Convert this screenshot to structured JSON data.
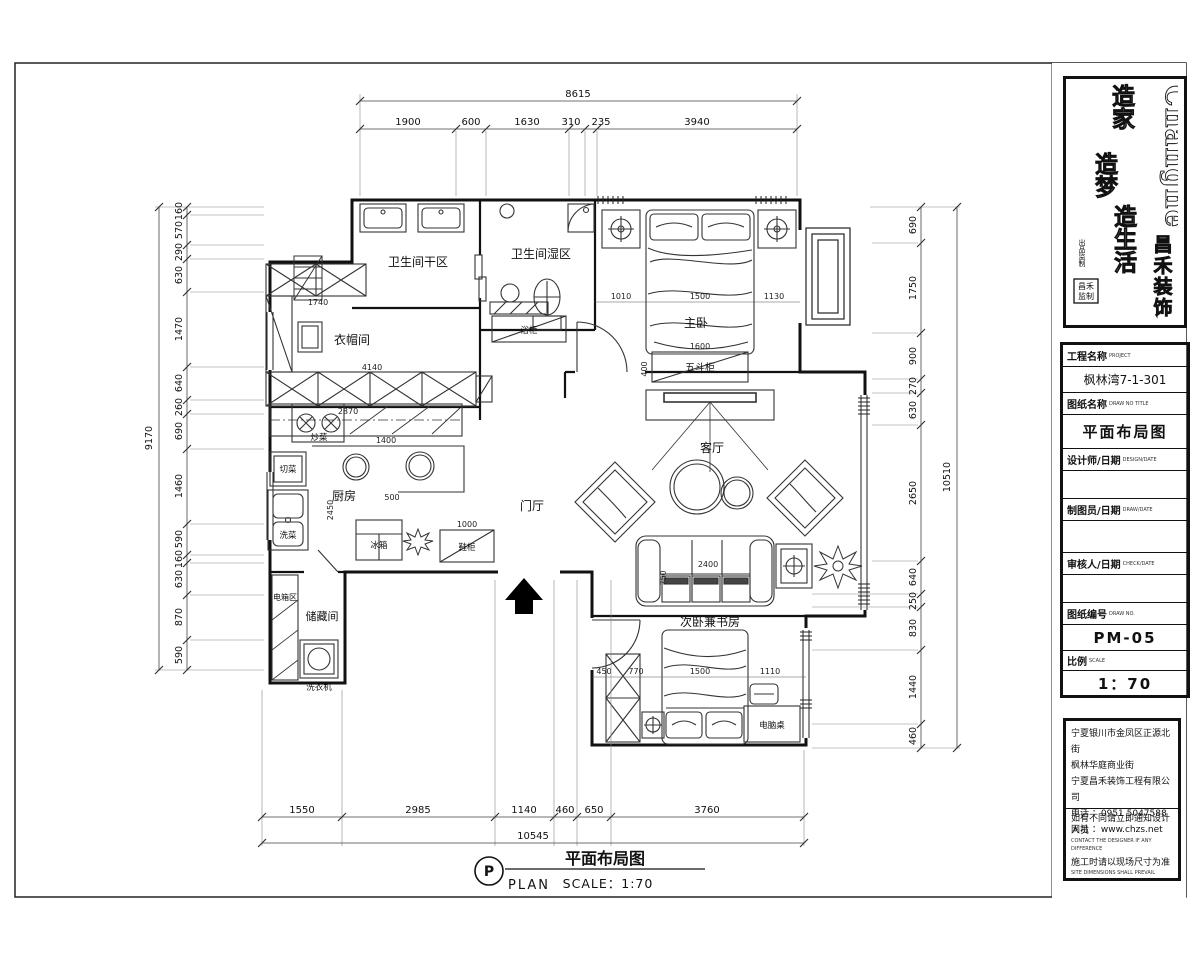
{
  "logo": {
    "brand_en": "Changhe",
    "brand_cn": [
      "昌",
      "禾",
      "装",
      "饰"
    ],
    "slogan1": "造家",
    "slogan2": "造梦",
    "slogan3": "造生活",
    "side_note": "出品监制",
    "seal_line1": "昌禾",
    "seal_line2": "监制"
  },
  "titleblock": {
    "project_label": "工程名称",
    "project_label_en": "PROJECT",
    "project_value": "枫林湾7-1-301",
    "drawing_label": "图纸名称",
    "drawing_label_en": "DRAW NO TITLE",
    "drawing_value": "平面布局图",
    "designer_label": "设计师/日期",
    "designer_label_en": "DESIGN/DATE",
    "drafter_label": "制图员/日期",
    "drafter_label_en": "DRAW/DATE",
    "checker_label": "审核人/日期",
    "checker_label_en": "CHECK/DATE",
    "number_label": "图纸编号",
    "number_label_en": "DRAW NO.",
    "number_value": "PM-05",
    "scale_label": "比例",
    "scale_label_en": "SCALE",
    "scale_value": "1：70"
  },
  "company": {
    "address_1": "宁夏银川市金凤区正源北街",
    "address_2": "枫林华庭商业街",
    "address_3": "宁夏昌禾装饰工程有限公司",
    "phone": "电话 ：0951 5047588",
    "web": "网址 ：www.chzs.net",
    "notice_1": "如有不同请立即通知设计人员",
    "notice_1_en": "CONTACT THE DESIGNER IF ANY DIFFERENCE",
    "notice_2": "施工时请以现场尺寸为准",
    "notice_2_en": "SITE DIMENSIONS SHALL PREVAIL"
  },
  "rooms": {
    "bath_dry": "卫生间干区",
    "bath_wet": "卫生间湿区",
    "master": "主卧",
    "cloak": "衣帽间",
    "kitchen": "厨房",
    "foyer": "门厅",
    "living": "客厅",
    "storage": "储藏间",
    "elec": "电箱区",
    "second": "次卧兼书房"
  },
  "furniture": {
    "chest": "五斗柜",
    "cut": "切菜",
    "wash": "洗菜",
    "cook": "炒菜",
    "fridge": "冰箱",
    "shoe": "鞋柜",
    "bathcab": "浴柜",
    "washer": "洗衣机",
    "desk": "电脑桌"
  },
  "inline": {
    "cloak_top": "1740",
    "cloak_bottom": "4140",
    "cloak_depth": "2870",
    "kitchen_w": "1400",
    "kitchen_island": "500",
    "kitchen_h": "2450",
    "shoe_w": "1000",
    "chest_w": "1600",
    "chest_d": "400",
    "mbed_left": "1010",
    "mbed_w": "1500",
    "mbed_right": "1130",
    "sofa_w": "2400",
    "sofa_d": "750",
    "bed2_a": "450",
    "bed2_b": "770",
    "bed2_c": "1500",
    "bed2_d": "1110"
  },
  "dims": {
    "top": {
      "total": "8615",
      "segments": [
        "1900",
        "600",
        "1630",
        "310",
        "235",
        "3940"
      ]
    },
    "left": {
      "total": "9170",
      "segments": [
        "160",
        "570",
        "290",
        "630",
        "1470",
        "640",
        "260",
        "690",
        "1460",
        "590",
        "160",
        "630",
        "870",
        "590"
      ]
    },
    "right": {
      "total": "10510",
      "segments": [
        "690",
        "1750",
        "900",
        "270",
        "630",
        "2650",
        "640",
        "250",
        "830",
        "1440",
        "460"
      ]
    },
    "bottom": {
      "total": "10545",
      "segments": [
        "1550",
        "2985",
        "1140",
        "460",
        "650",
        "3760"
      ]
    }
  },
  "caption": {
    "tag": "P",
    "plan_en": "PLAN",
    "title": "平面布局图",
    "scale": "SCALE：1:70"
  }
}
